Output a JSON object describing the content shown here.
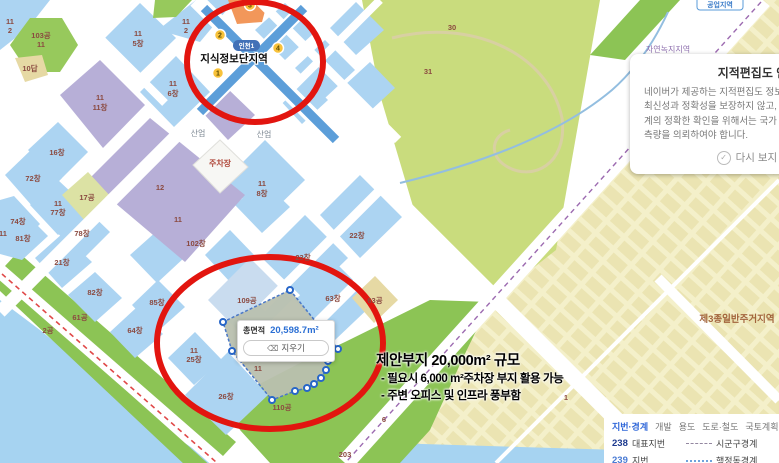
{
  "map": {
    "station": {
      "name": "지식정보단지역",
      "line_badge": "인천1",
      "exits": [
        {
          "n": "3",
          "x": 250,
          "y": 5
        },
        {
          "n": "2",
          "x": 220,
          "y": 35
        },
        {
          "n": "4",
          "x": 278,
          "y": 48
        },
        {
          "n": "1",
          "x": 218,
          "y": 73
        }
      ]
    },
    "zone_badge": "공업지역",
    "labels": [
      {
        "t": "11",
        "x": 10,
        "y": 24,
        "k": "p"
      },
      {
        "t": "2",
        "x": 10,
        "y": 33,
        "k": "p"
      },
      {
        "t": "103공",
        "x": 41,
        "y": 38,
        "k": "p"
      },
      {
        "t": "11",
        "x": 41,
        "y": 47,
        "k": "p"
      },
      {
        "t": "10답",
        "x": 30,
        "y": 71,
        "k": "p"
      },
      {
        "t": "11",
        "x": 138,
        "y": 36,
        "k": "p"
      },
      {
        "t": "5창",
        "x": 138,
        "y": 46,
        "k": "p"
      },
      {
        "t": "11",
        "x": 186,
        "y": 24,
        "k": "p"
      },
      {
        "t": "2",
        "x": 186,
        "y": 33,
        "k": "p"
      },
      {
        "t": "11",
        "x": 173,
        "y": 86,
        "k": "p"
      },
      {
        "t": "6창",
        "x": 173,
        "y": 96,
        "k": "p"
      },
      {
        "t": "16창",
        "x": 57,
        "y": 155,
        "k": "p"
      },
      {
        "t": "72창",
        "x": 33,
        "y": 181,
        "k": "p"
      },
      {
        "t": "74창",
        "x": 18,
        "y": 224,
        "k": "p"
      },
      {
        "t": "11",
        "x": 3,
        "y": 236,
        "k": "p"
      },
      {
        "t": "17공",
        "x": 87,
        "y": 200,
        "k": "p"
      },
      {
        "t": "11",
        "x": 58,
        "y": 206,
        "k": "p"
      },
      {
        "t": "77창",
        "x": 58,
        "y": 215,
        "k": "p"
      },
      {
        "t": "78창",
        "x": 82,
        "y": 236,
        "k": "p"
      },
      {
        "t": "81창",
        "x": 23,
        "y": 241,
        "k": "p"
      },
      {
        "t": "21창",
        "x": 62,
        "y": 265,
        "k": "p"
      },
      {
        "t": "11",
        "x": 100,
        "y": 100,
        "k": "p"
      },
      {
        "t": "11창",
        "x": 100,
        "y": 110,
        "k": "p"
      },
      {
        "t": "12",
        "x": 160,
        "y": 190,
        "k": "p"
      },
      {
        "t": "11",
        "x": 178,
        "y": 222,
        "k": "p"
      },
      {
        "t": "102창",
        "x": 196,
        "y": 246,
        "k": "p"
      },
      {
        "t": "11",
        "x": 262,
        "y": 186,
        "k": "p"
      },
      {
        "t": "8창",
        "x": 262,
        "y": 196,
        "k": "p"
      },
      {
        "t": "22창",
        "x": 357,
        "y": 238,
        "k": "p"
      },
      {
        "t": "23창",
        "x": 303,
        "y": 260,
        "k": "p"
      },
      {
        "t": "63창",
        "x": 333,
        "y": 301,
        "k": "p"
      },
      {
        "t": "82창",
        "x": 95,
        "y": 295,
        "k": "p"
      },
      {
        "t": "85창",
        "x": 157,
        "y": 305,
        "k": "p"
      },
      {
        "t": "64창",
        "x": 135,
        "y": 333,
        "k": "p"
      },
      {
        "t": "11",
        "x": 194,
        "y": 353,
        "k": "p"
      },
      {
        "t": "25창",
        "x": 194,
        "y": 362,
        "k": "p"
      },
      {
        "t": "26창",
        "x": 226,
        "y": 399,
        "k": "p"
      },
      {
        "t": "109공",
        "x": 247,
        "y": 303,
        "k": "p"
      },
      {
        "t": "110공",
        "x": 282,
        "y": 410,
        "k": "p"
      },
      {
        "t": "61공",
        "x": 80,
        "y": 320,
        "k": "p"
      },
      {
        "t": "2공",
        "x": 48,
        "y": 333,
        "k": "p"
      },
      {
        "t": "63공",
        "x": 375,
        "y": 303,
        "k": "p"
      },
      {
        "t": "11",
        "x": 258,
        "y": 371,
        "k": "p"
      },
      {
        "t": "31",
        "x": 428,
        "y": 74,
        "k": "p"
      },
      {
        "t": "30",
        "x": 452,
        "y": 30,
        "k": "p"
      },
      {
        "t": "6",
        "x": 384,
        "y": 422,
        "k": "p"
      },
      {
        "t": "203",
        "x": 345,
        "y": 457,
        "k": "p"
      },
      {
        "t": "1",
        "x": 566,
        "y": 400,
        "k": "p"
      },
      {
        "t": "산업",
        "x": 198,
        "y": 136,
        "k": "g"
      },
      {
        "t": "산업",
        "x": 264,
        "y": 137,
        "k": "g"
      },
      {
        "t": "주차장",
        "x": 220,
        "y": 166,
        "k": "pk"
      },
      {
        "t": "자연녹지지역",
        "x": 668,
        "y": 52,
        "k": "z1"
      },
      {
        "t": "제3종일반주거지역",
        "x": 737,
        "y": 322,
        "k": "z2"
      }
    ],
    "measure": {
      "area_label": "총면적",
      "area_value": "20,598.7m²",
      "clear_label": "지우기",
      "polygon": [
        [
          290,
          290
        ],
        [
          338,
          349
        ],
        [
          330,
          352
        ],
        [
          328,
          361
        ],
        [
          326,
          370
        ],
        [
          321,
          378
        ],
        [
          314,
          384
        ],
        [
          307,
          388
        ],
        [
          295,
          391
        ],
        [
          272,
          400
        ],
        [
          232,
          351
        ],
        [
          223,
          322
        ]
      ]
    }
  },
  "annotation": {
    "title": "제안부지 20,000m² 규모",
    "lines": [
      "- 필요시 6,000 m²주차장 부지 활용 가능",
      "- 주변 오피스 및 인프라 풍부함"
    ]
  },
  "notice": {
    "title": "지적편집도 안내",
    "body": "네이버가 제공하는 지적편집도 정보는 단순 참고용으로 그 최신성과 정확성을 보장하지 않고, 지적 경계선과 사실경계의 정확한 확인을 위해서는 국가 또는 공공기관에 지적측량을 의뢰하여야 합니다.",
    "dismiss_label": "다시 보지 않기"
  },
  "legend": {
    "tabs": [
      {
        "label": "지번·경계",
        "active": true
      },
      {
        "label": "개발",
        "active": false
      },
      {
        "label": "용도",
        "active": false
      },
      {
        "label": "도로·철도",
        "active": false
      },
      {
        "label": "국토계획",
        "active": false
      }
    ],
    "rows": [
      {
        "num": "238",
        "num_color": "#1d3a8f",
        "label": "대표지번",
        "line_style": "dashed",
        "line_color": "#9387a0",
        "line_label": "시군구경계"
      },
      {
        "num": "239",
        "num_color": "#4a7bd4",
        "label": "지번",
        "line_style": "dotted",
        "line_color": "#6fa3dc",
        "line_label": "행정동경계"
      }
    ]
  },
  "colors": {
    "annotation_red": "#e2150f",
    "parcel_blue": "#acd4f2",
    "parcel_purple": "#b7afd7",
    "park_green": "#c9dc7d",
    "strip_green": "#8cc455",
    "water_blue": "#a6d3f1",
    "residential": "#f4f0ca",
    "subway_blue": "#5c9ed9",
    "area_value_blue": "#2b6fd4"
  }
}
